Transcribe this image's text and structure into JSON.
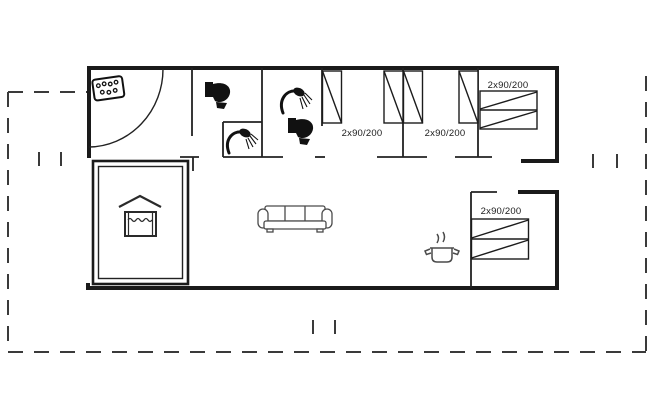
{
  "plan": {
    "type": "holiday-house-floor-plan",
    "rooms": [
      {
        "id": "bedroom-1",
        "bed_label": "2x90/200"
      },
      {
        "id": "bedroom-2",
        "bed_label": "2x90/200"
      },
      {
        "id": "bedroom-3",
        "bed_label": "2x90/200"
      },
      {
        "id": "bedroom-4",
        "bed_label": "2x90/200"
      }
    ],
    "icons": {
      "entry": "whirlpool-icon",
      "bathroom_1": [
        "toilet-icon",
        "shower-icon"
      ],
      "bathroom_2": [
        "shower-icon",
        "toilet-icon"
      ],
      "living_room": "sofa-icon",
      "kitchen": "cooking-pot-icon",
      "pool_room": "pool-icon"
    },
    "colors": {
      "wall": "#1a1a1a",
      "interior_wall": "#222222",
      "boundary_dashed": "#3a3a3a",
      "fixture_line": "#4a4a4a",
      "background": "#ffffff"
    }
  }
}
